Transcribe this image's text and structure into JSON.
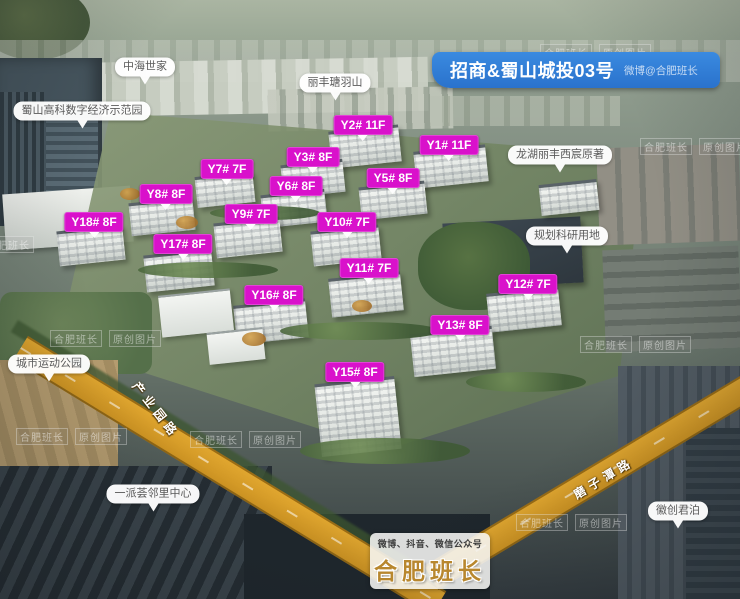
{
  "banner": {
    "title": "招商&蜀山城投03号",
    "credit": "微博@合肥班长"
  },
  "footer": {
    "channels": "微博、抖音、微信公众号",
    "brand": "合肥班长"
  },
  "watermark": {
    "brand": "合肥班长",
    "label": "原创图片"
  },
  "buildings": [
    {
      "label": "Y2# 11F"
    },
    {
      "label": "Y1# 11F"
    },
    {
      "label": "Y3# 8F"
    },
    {
      "label": "Y7# 7F"
    },
    {
      "label": "Y6# 8F"
    },
    {
      "label": "Y5# 8F"
    },
    {
      "label": "Y8# 8F"
    },
    {
      "label": "Y9# 7F"
    },
    {
      "label": "Y10# 7F"
    },
    {
      "label": "Y18# 8F"
    },
    {
      "label": "Y17# 8F"
    },
    {
      "label": "Y11# 7F"
    },
    {
      "label": "Y16# 8F"
    },
    {
      "label": "Y12# 7F"
    },
    {
      "label": "Y13# 8F"
    },
    {
      "label": "Y15# 8F"
    }
  ],
  "landmarks": [
    {
      "label": "中海世家"
    },
    {
      "label": "蜀山高科数字经济示范园"
    },
    {
      "label": "丽丰瑭羽山"
    },
    {
      "label": "龙湖丽丰西宸原著"
    },
    {
      "label": "规划科研用地"
    },
    {
      "label": "城市运动公园"
    },
    {
      "label": "一派荟邻里中心"
    },
    {
      "label": "徽创君泊"
    }
  ],
  "roads": [
    {
      "label": "产业园路"
    },
    {
      "label": "磨子潭路"
    }
  ],
  "colors": {
    "building_label": "#d911cb",
    "banner": "#2e7fd8",
    "road": "#d79b2e"
  }
}
